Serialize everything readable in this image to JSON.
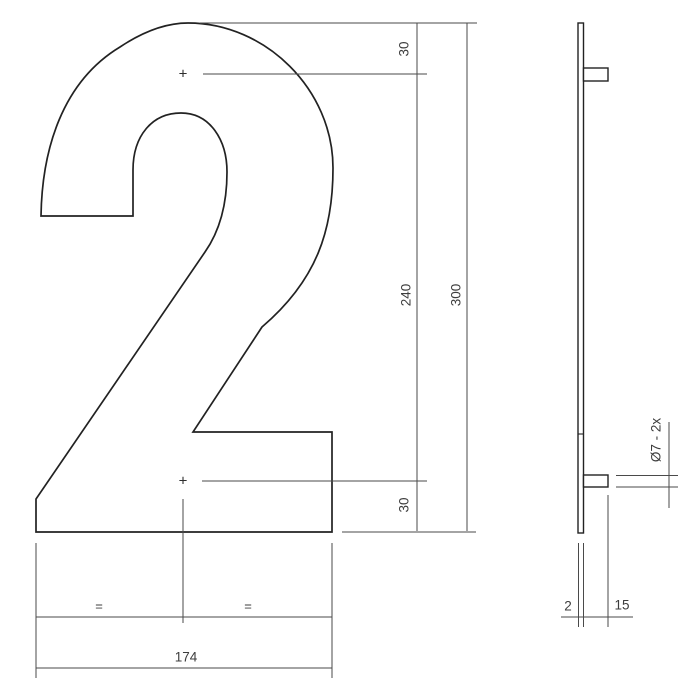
{
  "front_view": {
    "numeral": "2",
    "hole_marker": "+",
    "dims": {
      "top_offset": "30",
      "hole_spacing": "240",
      "total_height": "300",
      "bottom_offset": "30",
      "total_width": "174",
      "equal_left": "=",
      "equal_right": "="
    }
  },
  "side_view": {
    "dims": {
      "plate_thickness": "2",
      "stud_length": "15",
      "stud_spec": "Ø7 - 2x"
    }
  },
  "colors": {
    "object_line": "#222222",
    "dimension_line": "#4a4a4a",
    "text": "#3d3d3d",
    "background": "#ffffff"
  }
}
